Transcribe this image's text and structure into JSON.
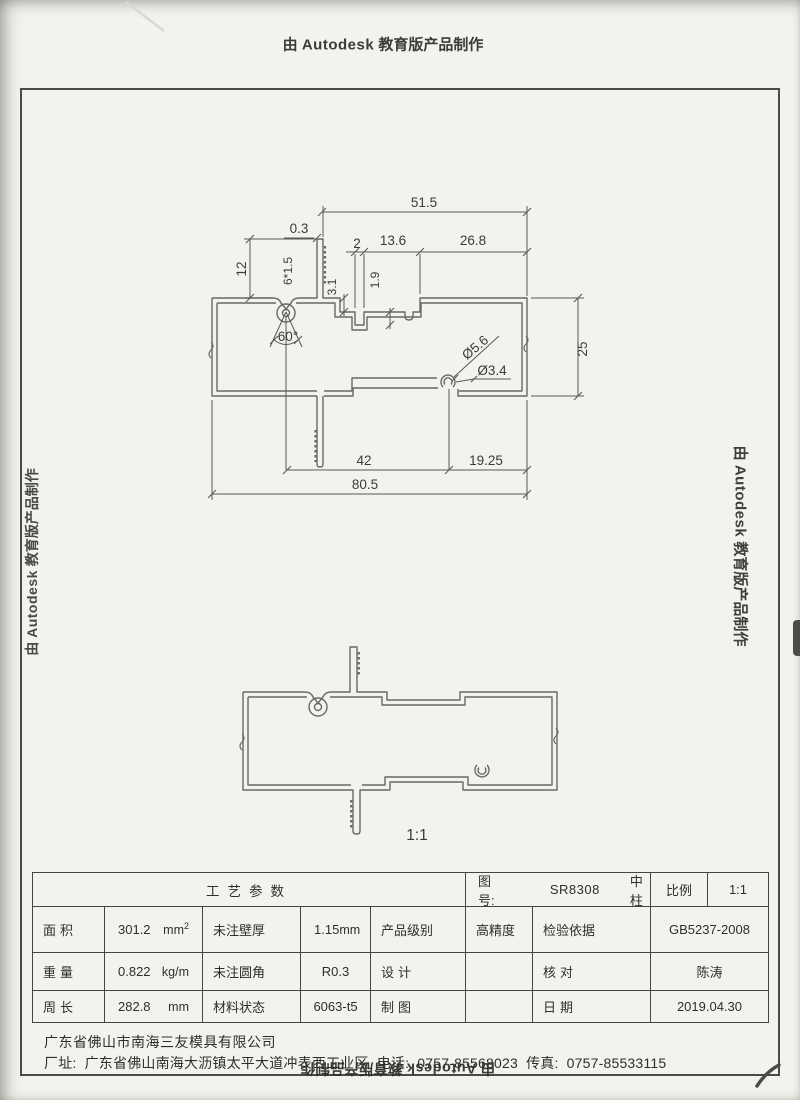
{
  "credits": {
    "prefix": "由 ",
    "brand": "Autodesk",
    "suffix": " 教育版产品制作"
  },
  "drawing1": {
    "dims": {
      "w515": "51.5",
      "w03": "0.3",
      "w2": "2",
      "w136": "13.6",
      "w268": "26.8",
      "h12": "12",
      "serr": "6*1.5",
      "h31": "3.1",
      "h19": "1.9",
      "ang60": "60°",
      "dia56": "Ø5.6",
      "dia34": "Ø3.4",
      "h25": "25",
      "w42": "42",
      "w1925": "19.25",
      "w805": "80.5"
    }
  },
  "drawing2": {
    "scale_label": "1:1"
  },
  "title_block": {
    "header": "工艺参数",
    "fig_label": "图号:",
    "fig_no": "SR8308",
    "part_name": "中柱",
    "scale_label": "比例",
    "scale_value": "1:1",
    "area_label": "面积",
    "area_value": "301.2",
    "area_unit": "mm",
    "area_sup": "2",
    "wall_label": "未注壁厚",
    "wall_value": "1.15",
    "wall_unit": "mm",
    "grade_label": "产品级别",
    "grade_value": "高精度",
    "standard_label": "检验依据",
    "standard_value": "GB5237-2008",
    "weight_label": "重量",
    "weight_value": "0.822",
    "weight_unit": "kg/m",
    "fillet_label": "未注圆角",
    "fillet_value": "R0.3",
    "design_label": "设计",
    "check_label": "核对",
    "check_value": "陈涛",
    "perimeter_label": "周长",
    "perimeter_value": "282.8",
    "perimeter_unit": "mm",
    "material_label": "材料状态",
    "material_value": "6063-t5",
    "draft_label": "制图",
    "date_label": "日期",
    "date_value": "2019.04.30"
  },
  "footer": {
    "company": "广东省佛山市南海三友模具有限公司",
    "address_label": "厂址:",
    "address": "广东省佛山南海大沥镇太平大道冲表西工业区",
    "phone_label": "电话:",
    "phone": "0757-85568023",
    "fax_label": "传真:",
    "fax": "0757-85533115"
  }
}
